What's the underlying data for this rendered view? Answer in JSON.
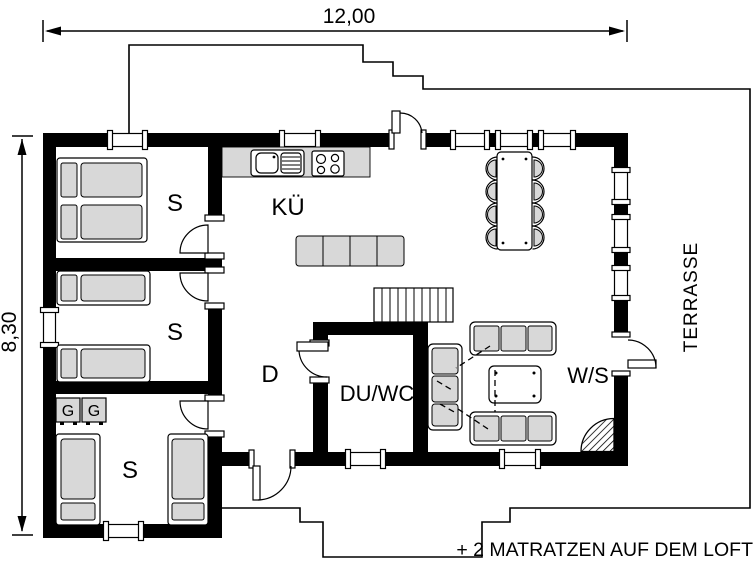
{
  "dimensions": {
    "width": "12,00",
    "height": "8,30"
  },
  "rooms": {
    "bedroom1": "S",
    "bedroom2": "S",
    "bedroom3": "S",
    "kitchen": "KÜ",
    "hallway": "D",
    "bath": "DU/WC",
    "living": "W/S",
    "terrace": "TERRASSE",
    "wardrobe_left": "G",
    "wardrobe_right": "G"
  },
  "annotation": "+ 2 MATRATZEN AUF DEM LOFT",
  "colors": {
    "walls": "#000000",
    "furniture": "#d8d8d8",
    "background": "#ffffff"
  }
}
